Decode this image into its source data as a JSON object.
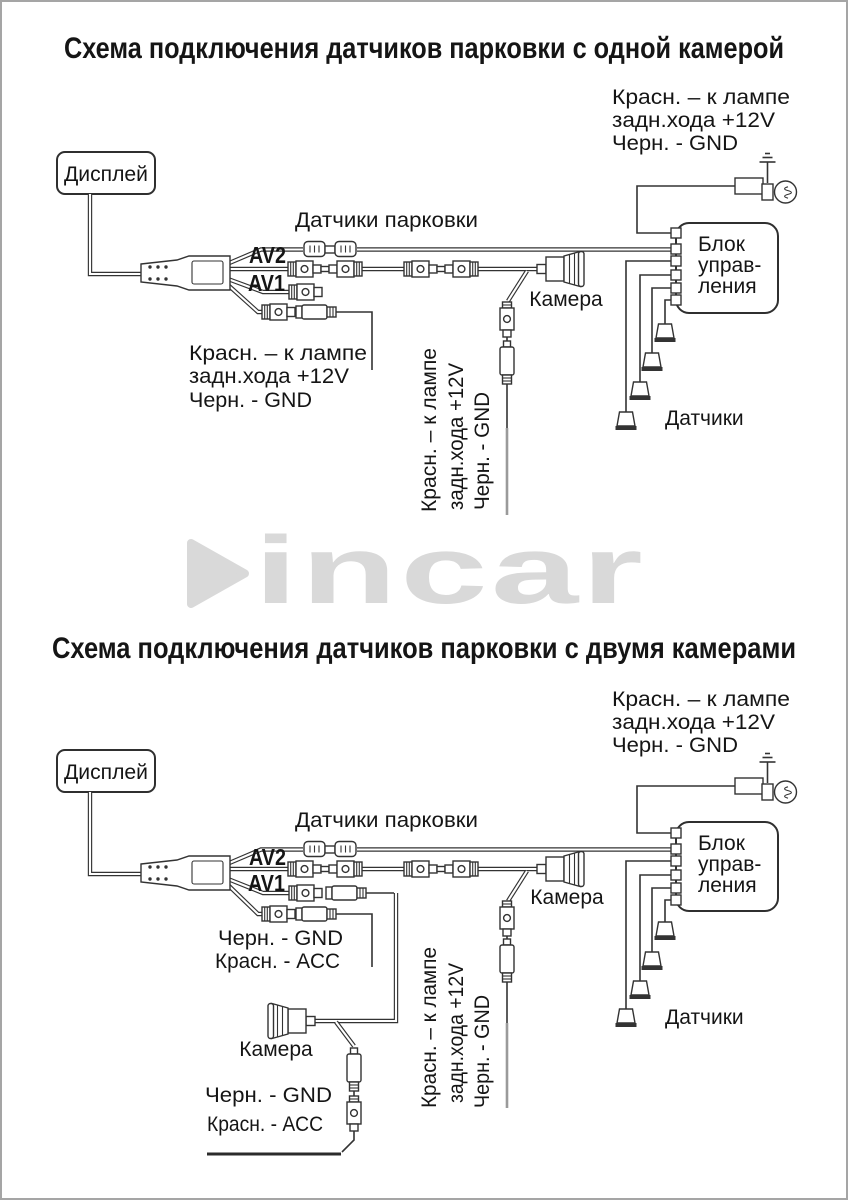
{
  "colors": {
    "ink": "#333333",
    "gray_wire": "#9a9a9a",
    "logo_gray": "#d9d9d9",
    "page_border": "#a5a5a5"
  },
  "logo": {
    "text": "incar"
  },
  "d1": {
    "title": "Схема подключения датчиков парковки с одной камерой",
    "display": "Дисплей",
    "note_right": [
      "Красн. – к лампе",
      "задн.хода +12V",
      "Черн. - GND"
    ],
    "sensors_cable_label": "Датчики парковки",
    "av2": "AV2",
    "av1": "AV1",
    "note_left": [
      "Красн. – к лампе",
      "задн.хода +12V",
      "Черн. - GND"
    ],
    "camera": "Камера",
    "vertical_note": [
      "Красн. – к лампе",
      "задн.хода +12V",
      "Черн. - GND"
    ],
    "control_unit": [
      "Блок",
      "управ-",
      "ления"
    ],
    "sensors_label": "Датчики"
  },
  "d2": {
    "title": "Схема подключения датчиков парковки с двумя камерами",
    "display": "Дисплей",
    "note_right": [
      "Красн. – к лампе",
      "задн.хода +12V",
      "Черн. - GND"
    ],
    "sensors_cable_label": "Датчики парковки",
    "av2": "AV2",
    "av1": "AV1",
    "av1_note": [
      "Черн. - GND",
      "Красн. - ACC"
    ],
    "camera1": "Камера",
    "camera2": "Камера",
    "camera2_note": [
      "Черн. - GND",
      "Красн. - ACC"
    ],
    "vertical_note": [
      "Красн. – к лампе",
      "задн.хода +12V",
      "Черн. - GND"
    ],
    "control_unit": [
      "Блок",
      "управ-",
      "ления"
    ],
    "sensors_label": "Датчики"
  }
}
